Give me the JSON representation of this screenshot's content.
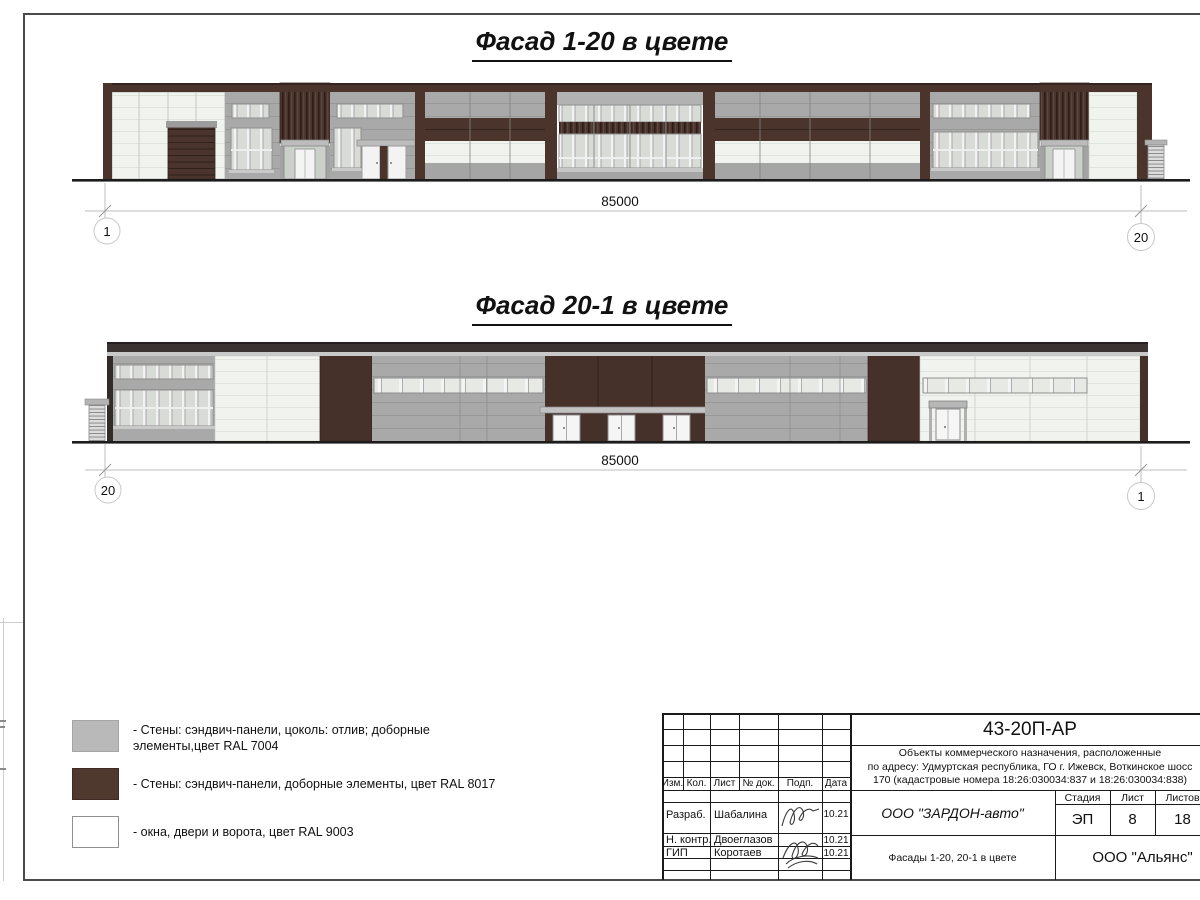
{
  "facade_top": {
    "title": "Фасад 1-20 в цвете",
    "dimension": "85000",
    "axis_left": "1",
    "axis_right": "20"
  },
  "facade_bottom": {
    "title": "Фасад 20-1 в цвете",
    "dimension": "85000",
    "axis_left": "20",
    "axis_right": "1"
  },
  "legend": {
    "items": [
      {
        "color": "#b9b9b9",
        "line1": "- Стены: сэндвич-панели, цоколь: отлив; доборные",
        "line2": "элементы,цвет RAL 7004"
      },
      {
        "color": "#4f382e",
        "line1": "- Стены: сэндвич-панели, доборные элементы, цвет RAL 8017",
        "line2": ""
      },
      {
        "color": "#ffffff",
        "line1": "- окна, двери и ворота, цвет RAL 9003",
        "line2": ""
      }
    ]
  },
  "title_block": {
    "doc_number": "43-20П-АР",
    "description_line1": "Объекты коммерческого назначения, расположенные",
    "description_line2": "по адресу: Удмуртская республика, ГО г. Ижевск, Воткинское шосс",
    "description_line3": "170 (кадастровые номера 18:26:030034:837 и 18:26:030034:838)",
    "col_izm": "Изм.",
    "col_kol": "Кол.",
    "col_list": "Лист",
    "col_doc": "№ док.",
    "col_podp": "Подп.",
    "col_data": "Дата",
    "rows": [
      {
        "role": "Разраб.",
        "name": "Шабалина",
        "date": "10.21"
      },
      {
        "role": "Н. контр.",
        "name": "Двоеглазов",
        "date": "10.21"
      },
      {
        "role": "ГИП",
        "name": "Коротаев",
        "date": "10.21"
      }
    ],
    "company": "ООО \"ЗАРДОН-авто\"",
    "sheet_name": "Фасады 1-20, 20-1 в цвете",
    "stage_label": "Стадия",
    "sheet_label": "Лист",
    "sheets_label": "Листов",
    "stage_value": "ЭП",
    "sheet_value": "8",
    "sheets_value": "18",
    "contractor": "ООО \"Альянс\""
  }
}
